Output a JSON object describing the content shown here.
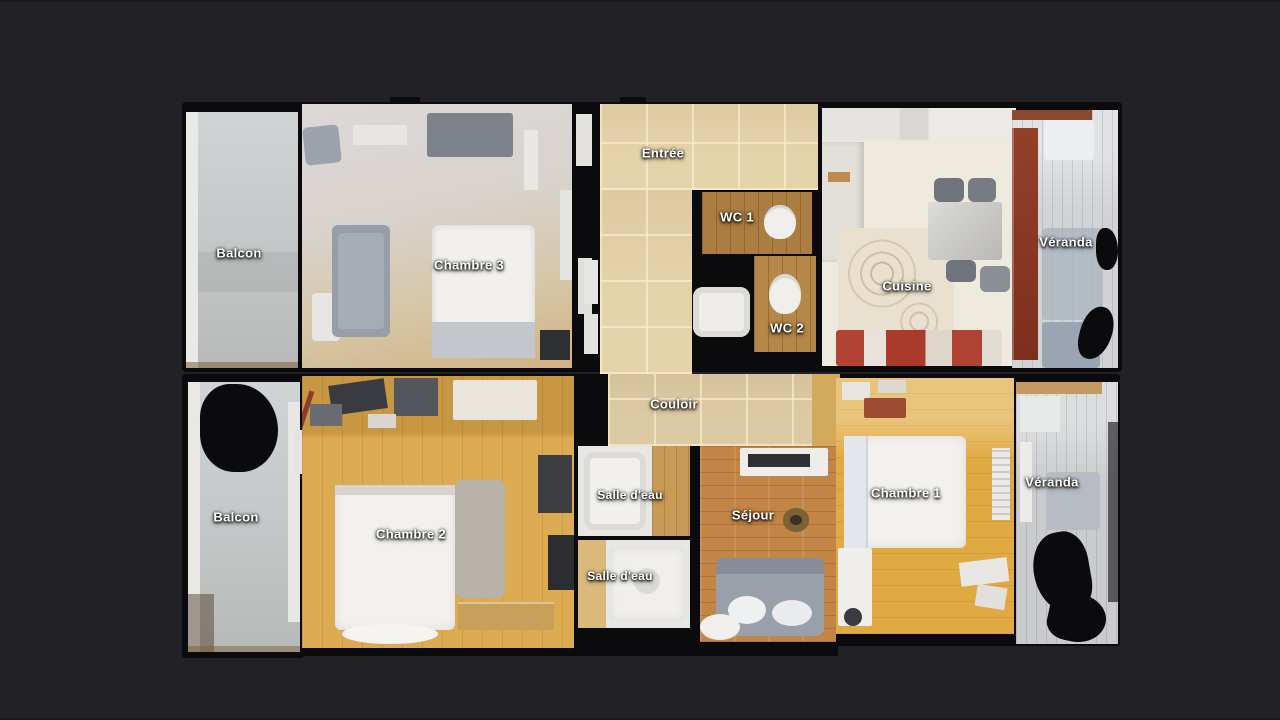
{
  "scene": {
    "description": "Top-down 3D dollhouse scan floor plan of an apartment with labelled rooms",
    "background_color": "#212126",
    "wall_silhouette_color": "#0b0b0d",
    "label_text_color": "#ffffff"
  },
  "palette": {
    "balcony_gray": "#c6c9ca",
    "tile_beige": "#e5d3aa",
    "carpet_gray": "#d8d4d3",
    "wood_gold": "#dcab52",
    "wood_honey": "#e0aa42",
    "wood_brown": "#c28546",
    "veranda_planks": "#d1d3d5",
    "furniture_white": "#f2f0ed",
    "sofa_gray": "#99a0aa",
    "kitchen_accent_red": "#a63527"
  },
  "rooms": [
    {
      "name": "Balcon"
    },
    {
      "name": "Chambre 3"
    },
    {
      "name": "Entrée"
    },
    {
      "name": "WC 1"
    },
    {
      "name": "WC 2"
    },
    {
      "name": "Cuisine"
    },
    {
      "name": "Véranda"
    },
    {
      "name": "Couloir"
    },
    {
      "name": "Balcon"
    },
    {
      "name": "Chambre 2"
    },
    {
      "name": "Salle d'eau"
    },
    {
      "name": "Salle d'eau"
    },
    {
      "name": "Séjour"
    },
    {
      "name": "Chambre 1"
    },
    {
      "name": "Véranda"
    }
  ]
}
